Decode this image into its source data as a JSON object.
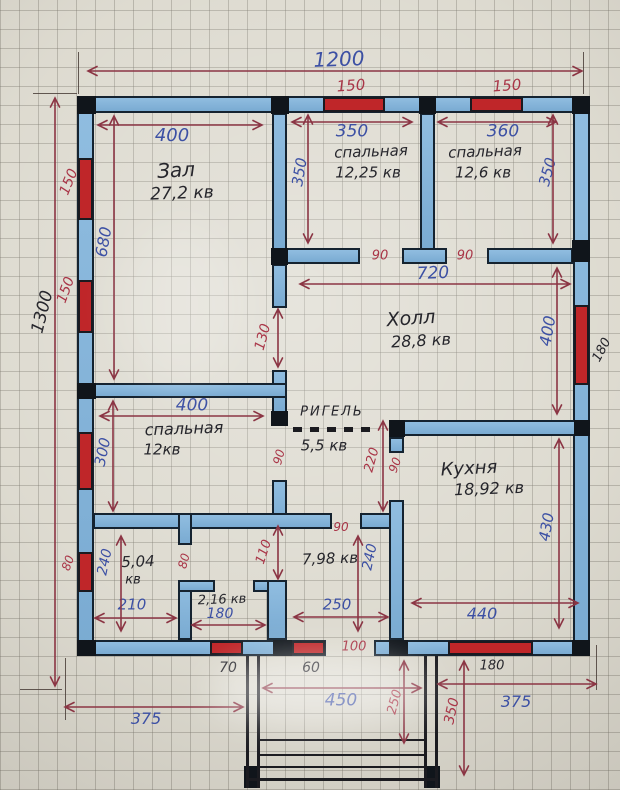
{
  "meta": {
    "type": "hand-drawn floor plan on graph paper",
    "units_note": "cm"
  },
  "plan": {
    "overall": {
      "width": "1200",
      "height": "1300"
    },
    "beam_label": "РИГЕЛЬ",
    "rooms": [
      {
        "name": "Зал",
        "area": "27,2 кв",
        "width": "400",
        "height": "680"
      },
      {
        "name": "спальная",
        "area": "12,25 кв",
        "width": "350",
        "height": "350"
      },
      {
        "name": "спальная",
        "area": "12,6 кв",
        "width": "360",
        "height": "350"
      },
      {
        "name": "Холл",
        "area": "28,8 кв",
        "width": "720",
        "height": "400"
      },
      {
        "name": "спальная",
        "area": "12кв",
        "width": "400",
        "height": "300"
      },
      {
        "name": "",
        "area": "5,5 кв",
        "height": "220"
      },
      {
        "name": "Кухня",
        "area": "18,92 кв",
        "width": "440",
        "height": "430"
      },
      {
        "name": "",
        "area": "5,04 кв",
        "width": "210",
        "height": "240"
      },
      {
        "name": "",
        "area": "2,16 кв",
        "width": "180"
      },
      {
        "name": "",
        "area": "7,98 кв",
        "width": "250",
        "height": "240"
      }
    ],
    "openings": [
      "90",
      "90",
      "130",
      "90",
      "90",
      "80",
      "110",
      "100"
    ],
    "windows": [
      "150",
      "150",
      "150",
      "150",
      "80",
      "180",
      "70",
      "60",
      "180"
    ],
    "porch": {
      "width": "450",
      "depth": "350",
      "step_line": "250",
      "sides": [
        "375",
        "375"
      ]
    }
  },
  "render": {
    "ink": {
      "blue": "#3c50a4",
      "red": "#a93547",
      "black": "#26262c",
      "arrow": "#8b3544"
    },
    "walls": [
      [
        77,
        96,
        513,
        17
      ],
      [
        77,
        96,
        17,
        560
      ],
      [
        573,
        96,
        17,
        560
      ],
      [
        77,
        640,
        249,
        16
      ],
      [
        374,
        640,
        216,
        16
      ],
      [
        272,
        113,
        15,
        137
      ],
      [
        420,
        113,
        15,
        137
      ],
      [
        272,
        248,
        88,
        16
      ],
      [
        402,
        248,
        45,
        16
      ],
      [
        487,
        248,
        86,
        16
      ],
      [
        272,
        264,
        15,
        44
      ],
      [
        272,
        370,
        15,
        44
      ],
      [
        93,
        383,
        194,
        15
      ],
      [
        272,
        480,
        15,
        49
      ],
      [
        93,
        513,
        239,
        16
      ],
      [
        360,
        513,
        44,
        16
      ],
      [
        178,
        513,
        14,
        32
      ],
      [
        178,
        582,
        14,
        58
      ],
      [
        178,
        580,
        37,
        12
      ],
      [
        253,
        580,
        34,
        12
      ],
      [
        267,
        580,
        20,
        60
      ],
      [
        389,
        437,
        15,
        16
      ],
      [
        389,
        500,
        15,
        140
      ],
      [
        389,
        420,
        201,
        16
      ]
    ],
    "windows": [
      [
        323,
        97,
        62,
        15
      ],
      [
        470,
        97,
        53,
        15
      ],
      [
        78,
        158,
        15,
        62
      ],
      [
        78,
        280,
        15,
        53
      ],
      [
        78,
        432,
        15,
        58
      ],
      [
        78,
        552,
        15,
        40
      ],
      [
        574,
        305,
        15,
        80
      ],
      [
        210,
        641,
        33,
        14
      ],
      [
        292,
        641,
        33,
        14
      ],
      [
        448,
        641,
        85,
        14
      ]
    ],
    "posts": [
      [
        77,
        96,
        19,
        18
      ],
      [
        271,
        96,
        18,
        18
      ],
      [
        419,
        96,
        17,
        18
      ],
      [
        572,
        96,
        18,
        18
      ],
      [
        572,
        240,
        18,
        22
      ],
      [
        271,
        248,
        17,
        17
      ],
      [
        77,
        383,
        19,
        16
      ],
      [
        271,
        411,
        17,
        15
      ],
      [
        389,
        420,
        16,
        17
      ],
      [
        574,
        420,
        16,
        16
      ],
      [
        77,
        640,
        19,
        16
      ],
      [
        273,
        640,
        19,
        16
      ],
      [
        389,
        640,
        19,
        16
      ],
      [
        572,
        640,
        18,
        16
      ],
      [
        244,
        766,
        16,
        22
      ],
      [
        424,
        766,
        16,
        22
      ]
    ],
    "lines": [
      [
        246,
        656,
        3,
        132
      ],
      [
        257,
        656,
        3,
        132
      ],
      [
        424,
        656,
        3,
        132
      ],
      [
        435,
        656,
        3,
        132
      ],
      [
        260,
        739,
        164,
        2
      ],
      [
        260,
        754,
        164,
        2
      ],
      [
        260,
        766,
        164,
        2
      ],
      [
        248,
        778,
        190,
        3
      ]
    ],
    "ext_lines": [
      [
        78,
        52,
        1,
        42
      ],
      [
        583,
        52,
        1,
        42
      ],
      [
        33,
        93,
        44,
        1
      ],
      [
        20,
        689,
        42,
        1
      ],
      [
        596,
        645,
        1,
        45
      ],
      [
        65,
        658,
        1,
        62
      ]
    ],
    "beam_dashes": [
      [
        293,
        427,
        80,
        5
      ]
    ],
    "dims": [
      [
        88,
        71,
        582,
        71
      ],
      [
        98,
        125,
        262,
        125
      ],
      [
        292,
        122,
        412,
        122
      ],
      [
        438,
        122,
        556,
        122
      ],
      [
        300,
        284,
        570,
        284
      ],
      [
        100,
        416,
        263,
        416
      ],
      [
        95,
        618,
        176,
        618
      ],
      [
        192,
        625,
        265,
        625
      ],
      [
        294,
        617,
        388,
        617
      ],
      [
        412,
        603,
        578,
        603
      ],
      [
        65,
        707,
        243,
        707
      ],
      [
        263,
        688,
        421,
        688
      ],
      [
        438,
        684,
        596,
        684
      ],
      [
        55,
        98,
        55,
        686
      ],
      [
        114,
        116,
        114,
        379
      ],
      [
        308,
        115,
        308,
        243
      ],
      [
        553,
        115,
        553,
        243
      ],
      [
        557,
        268,
        557,
        414
      ],
      [
        278,
        309,
        278,
        367
      ],
      [
        113,
        401,
        113,
        511
      ],
      [
        383,
        421,
        383,
        511
      ],
      [
        121,
        536,
        121,
        631
      ],
      [
        278,
        526,
        278,
        579
      ],
      [
        358,
        536,
        358,
        631
      ],
      [
        559,
        439,
        559,
        628
      ],
      [
        404,
        661,
        404,
        743
      ],
      [
        464,
        661,
        464,
        775
      ]
    ],
    "labels": [
      {
        "t": "1200",
        "x": 339,
        "y": 59,
        "c": "blue",
        "s": 20,
        "r": -2,
        "n": "dim-overall-width"
      },
      {
        "t": "150",
        "x": 351,
        "y": 86,
        "c": "red",
        "s": 15,
        "r": -4,
        "n": "dim-window"
      },
      {
        "t": "150",
        "x": 507,
        "y": 86,
        "c": "red",
        "s": 15,
        "r": -4,
        "n": "dim-window"
      },
      {
        "t": "400",
        "x": 172,
        "y": 136,
        "c": "blue",
        "s": 18,
        "n": "dim-room"
      },
      {
        "t": "350",
        "x": 352,
        "y": 132,
        "c": "blue",
        "s": 17,
        "n": "dim-room"
      },
      {
        "t": "360",
        "x": 503,
        "y": 132,
        "c": "blue",
        "s": 17,
        "n": "dim-room"
      },
      {
        "t": "Зал",
        "x": 176,
        "y": 170,
        "c": "black",
        "s": 20,
        "r": -3,
        "n": "room-name"
      },
      {
        "t": "27,2 кв",
        "x": 182,
        "y": 194,
        "c": "black",
        "s": 17,
        "r": -2,
        "n": "room-area"
      },
      {
        "t": "спальная",
        "x": 371,
        "y": 152,
        "c": "black",
        "s": 15,
        "r": -2,
        "n": "room-name"
      },
      {
        "t": "12,25 кв",
        "x": 368,
        "y": 173,
        "c": "black",
        "s": 15,
        "n": "room-area"
      },
      {
        "t": "спальная",
        "x": 485,
        "y": 152,
        "c": "black",
        "s": 15,
        "r": -2,
        "n": "room-name"
      },
      {
        "t": "12,6 кв",
        "x": 483,
        "y": 173,
        "c": "black",
        "s": 15,
        "n": "room-area"
      },
      {
        "t": "350",
        "x": 300,
        "y": 172,
        "c": "blue",
        "s": 15,
        "r": -80,
        "n": "dim-room"
      },
      {
        "t": "350",
        "x": 548,
        "y": 172,
        "c": "blue",
        "s": 15,
        "r": -75,
        "n": "dim-room"
      },
      {
        "t": "150",
        "x": 69,
        "y": 182,
        "c": "red",
        "s": 14,
        "r": -68,
        "n": "dim-window"
      },
      {
        "t": "150",
        "x": 66,
        "y": 290,
        "c": "red",
        "s": 14,
        "r": -70,
        "n": "dim-window"
      },
      {
        "t": "1300",
        "x": 43,
        "y": 312,
        "c": "black",
        "s": 17,
        "r": -76,
        "n": "dim-overall-height"
      },
      {
        "t": "680",
        "x": 104,
        "y": 242,
        "c": "blue",
        "s": 16,
        "r": -80,
        "n": "dim-room"
      },
      {
        "t": "90",
        "x": 380,
        "y": 256,
        "c": "red",
        "s": 13,
        "n": "dim-door"
      },
      {
        "t": "90",
        "x": 465,
        "y": 256,
        "c": "red",
        "s": 13,
        "n": "dim-door"
      },
      {
        "t": "720",
        "x": 433,
        "y": 274,
        "c": "blue",
        "s": 17,
        "r": -2,
        "n": "dim-room"
      },
      {
        "t": "Холл",
        "x": 411,
        "y": 319,
        "c": "black",
        "s": 19,
        "r": -4,
        "n": "room-name"
      },
      {
        "t": "28,8 кв",
        "x": 421,
        "y": 341,
        "c": "black",
        "s": 16,
        "r": -3,
        "n": "room-area"
      },
      {
        "t": "400",
        "x": 548,
        "y": 331,
        "c": "blue",
        "s": 16,
        "r": -80,
        "n": "dim-room"
      },
      {
        "t": "130",
        "x": 263,
        "y": 337,
        "c": "red",
        "s": 14,
        "r": -75,
        "n": "dim-opening"
      },
      {
        "t": "180",
        "x": 602,
        "y": 350,
        "c": "black",
        "s": 13,
        "r": -62,
        "n": "dim-window"
      },
      {
        "t": "400",
        "x": 192,
        "y": 406,
        "c": "blue",
        "s": 17,
        "n": "dim-room"
      },
      {
        "t": "спальная",
        "x": 184,
        "y": 429,
        "c": "black",
        "s": 16,
        "r": -2,
        "n": "room-name"
      },
      {
        "t": "12кв",
        "x": 162,
        "y": 450,
        "c": "black",
        "s": 15,
        "n": "room-area"
      },
      {
        "t": "300",
        "x": 103,
        "y": 452,
        "c": "blue",
        "s": 15,
        "r": -78,
        "n": "dim-room"
      },
      {
        "t": "РИГЕЛЬ",
        "x": 332,
        "y": 412,
        "c": "black",
        "s": 13,
        "ls": 2,
        "n": "beam-label"
      },
      {
        "t": "5,5 кв",
        "x": 324,
        "y": 446,
        "c": "black",
        "s": 15,
        "n": "room-area"
      },
      {
        "t": "90",
        "x": 279,
        "y": 457,
        "c": "red",
        "s": 12,
        "r": -75,
        "n": "dim-door"
      },
      {
        "t": "220",
        "x": 372,
        "y": 460,
        "c": "red",
        "s": 13,
        "r": -75,
        "n": "dim-room"
      },
      {
        "t": "90",
        "x": 395,
        "y": 465,
        "c": "red",
        "s": 12,
        "r": -70,
        "n": "dim-door"
      },
      {
        "t": "Кухня",
        "x": 469,
        "y": 469,
        "c": "black",
        "s": 18,
        "r": -3,
        "n": "room-name"
      },
      {
        "t": "18,92 кв",
        "x": 489,
        "y": 489,
        "c": "black",
        "s": 16,
        "r": -2,
        "n": "room-area"
      },
      {
        "t": "90",
        "x": 341,
        "y": 527,
        "c": "red",
        "s": 12,
        "n": "dim-door"
      },
      {
        "t": "80",
        "x": 68,
        "y": 563,
        "c": "red",
        "s": 12,
        "r": -70,
        "n": "dim-window"
      },
      {
        "t": "240",
        "x": 105,
        "y": 562,
        "c": "blue",
        "s": 14,
        "r": -78,
        "n": "dim-room"
      },
      {
        "t": "5,04",
        "x": 138,
        "y": 562,
        "c": "black",
        "s": 15,
        "r": -2,
        "n": "room-area"
      },
      {
        "t": "кв",
        "x": 133,
        "y": 580,
        "c": "black",
        "s": 13,
        "n": "room-area"
      },
      {
        "t": "80",
        "x": 184,
        "y": 561,
        "c": "red",
        "s": 12,
        "r": -75,
        "n": "dim-door"
      },
      {
        "t": "110",
        "x": 264,
        "y": 552,
        "c": "red",
        "s": 13,
        "r": -72,
        "n": "dim-door"
      },
      {
        "t": "7,98 кв",
        "x": 330,
        "y": 559,
        "c": "black",
        "s": 15,
        "r": -2,
        "n": "room-area"
      },
      {
        "t": "240",
        "x": 370,
        "y": 557,
        "c": "blue",
        "s": 14,
        "r": -78,
        "n": "dim-room"
      },
      {
        "t": "210",
        "x": 132,
        "y": 605,
        "c": "blue",
        "s": 15,
        "n": "dim-room"
      },
      {
        "t": "2,16 кв",
        "x": 222,
        "y": 600,
        "c": "black",
        "s": 13,
        "r": -2,
        "n": "room-area"
      },
      {
        "t": "180",
        "x": 220,
        "y": 614,
        "c": "blue",
        "s": 14,
        "n": "dim-room"
      },
      {
        "t": "250",
        "x": 337,
        "y": 605,
        "c": "blue",
        "s": 15,
        "n": "dim-room"
      },
      {
        "t": "100",
        "x": 354,
        "y": 647,
        "c": "red",
        "s": 13,
        "n": "dim-opening"
      },
      {
        "t": "440",
        "x": 482,
        "y": 614,
        "c": "blue",
        "s": 16,
        "n": "dim-room"
      },
      {
        "t": "430",
        "x": 547,
        "y": 527,
        "c": "blue",
        "s": 15,
        "r": -80,
        "n": "dim-room"
      },
      {
        "t": "70",
        "x": 228,
        "y": 668,
        "c": "black",
        "s": 14,
        "n": "dim-window"
      },
      {
        "t": "60",
        "x": 311,
        "y": 668,
        "c": "black",
        "s": 14,
        "n": "dim-window"
      },
      {
        "t": "180",
        "x": 492,
        "y": 666,
        "c": "black",
        "s": 13,
        "n": "dim-window"
      },
      {
        "t": "375",
        "x": 146,
        "y": 719,
        "c": "blue",
        "s": 16,
        "n": "dim-site"
      },
      {
        "t": "450",
        "x": 341,
        "y": 701,
        "c": "blue",
        "s": 17,
        "n": "dim-porch"
      },
      {
        "t": "250",
        "x": 395,
        "y": 702,
        "c": "red",
        "s": 13,
        "r": -75,
        "n": "dim-porch"
      },
      {
        "t": "350",
        "x": 452,
        "y": 711,
        "c": "red",
        "s": 14,
        "r": -78,
        "n": "dim-porch"
      },
      {
        "t": "375",
        "x": 516,
        "y": 702,
        "c": "blue",
        "s": 16,
        "n": "dim-site"
      }
    ]
  }
}
